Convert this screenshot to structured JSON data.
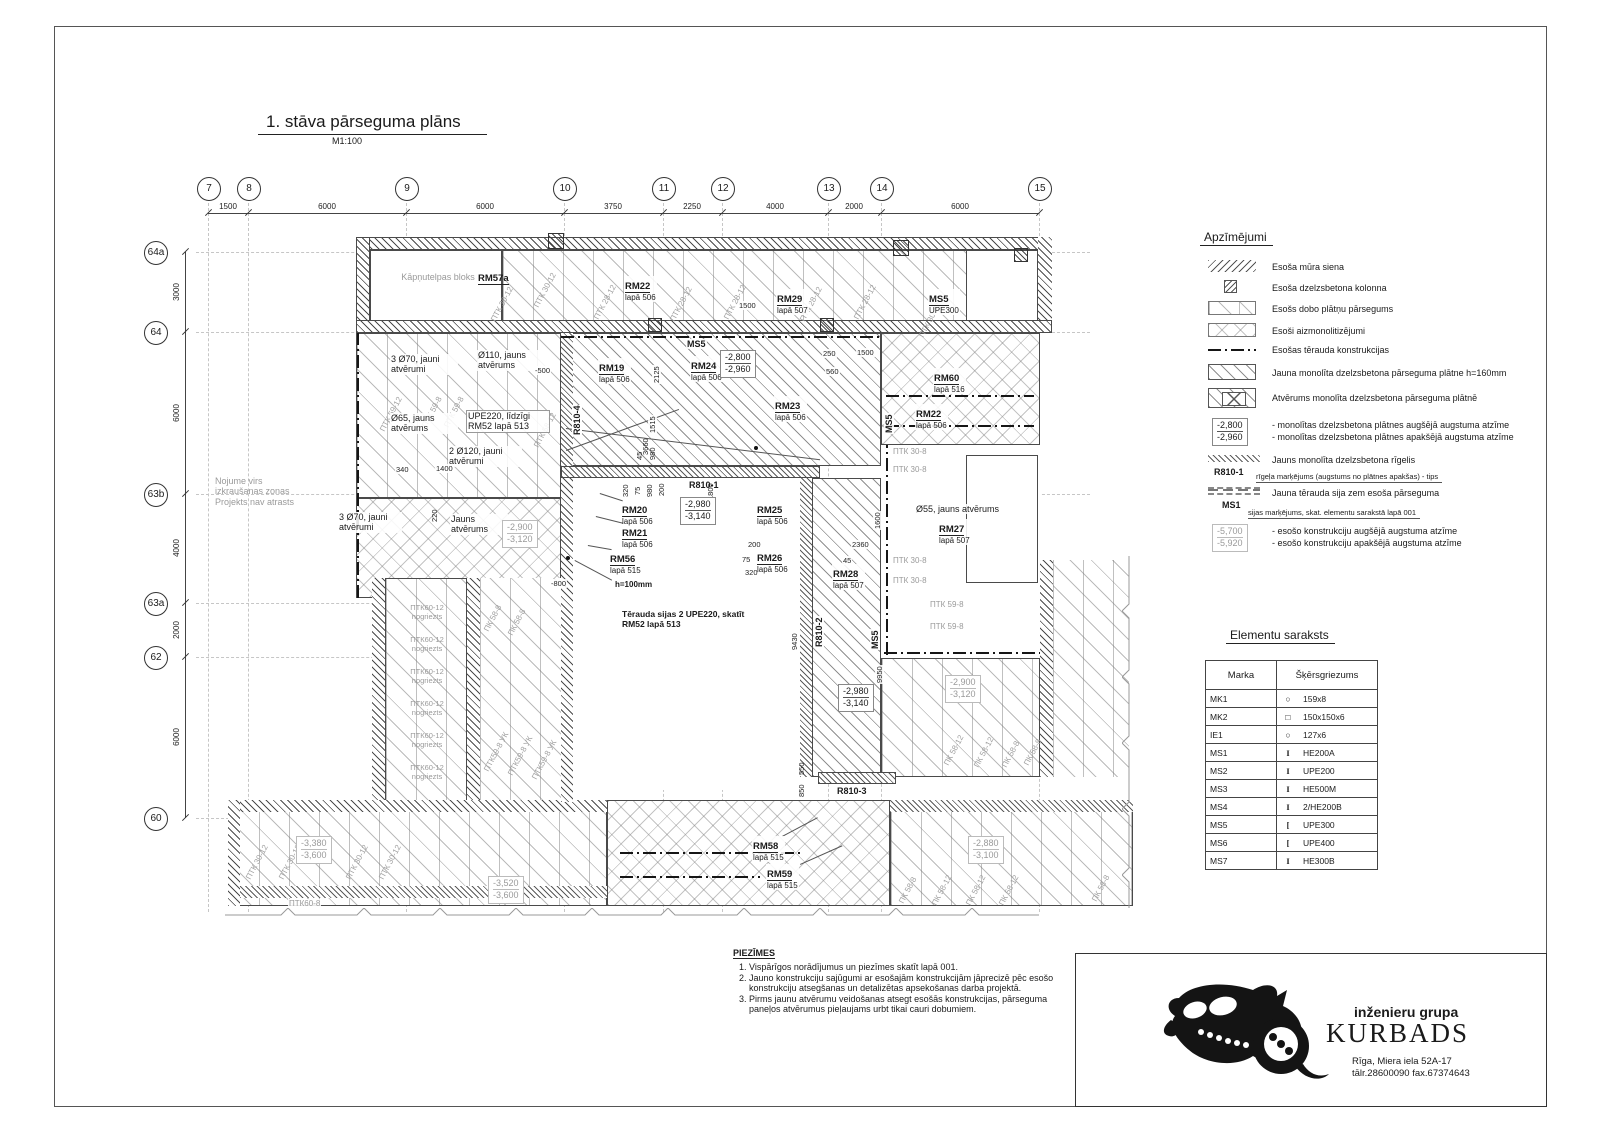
{
  "sheet": {
    "title": "1. stāva pārseguma plāns",
    "scale": "M1:100"
  },
  "colors": {
    "ink": "#1a1a1a",
    "gray_note": "#9a9a9a",
    "grid": "#c6c6c6"
  },
  "grid": {
    "col_labels": [
      "7",
      "8",
      "9",
      "10",
      "11",
      "12",
      "13",
      "14",
      "15"
    ],
    "col_dims": [
      "1500",
      "6000",
      "6000",
      "3750",
      "2250",
      "4000",
      "2000",
      "6000"
    ],
    "row_labels": [
      "64a",
      "64",
      "63b",
      "63a",
      "62",
      "60"
    ],
    "row_dims": [
      "3000",
      "6000",
      "4000",
      "2000",
      "6000"
    ]
  },
  "plan": {
    "stair_block": "Kāpņutelpas bloks",
    "canopy": {
      "l1": "Nojume virs",
      "l2": "izkraušanas zonas",
      "l3": "Projekts nav atrasts"
    },
    "marks": {
      "rm57a": {
        "name": "RM57a",
        "ref": ""
      },
      "rm22a": {
        "name": "RM22",
        "ref": "lapā 506"
      },
      "rm29": {
        "name": "RM29",
        "ref": "lapā 507"
      },
      "ms5upe": {
        "name": "MS5",
        "ref": "UPE300"
      },
      "rm19": {
        "name": "RM19",
        "ref": "lapā 506"
      },
      "ms5": {
        "name": "MS5",
        "ref": ""
      },
      "rm24": {
        "name": "RM24",
        "ref": "lapā 506"
      },
      "rm23": {
        "name": "RM23",
        "ref": "lapā 506"
      },
      "rm60": {
        "name": "RM60",
        "ref": "lapā 516"
      },
      "rm22b": {
        "name": "RM22",
        "ref": "lapā 506"
      },
      "rm20": {
        "name": "RM20",
        "ref": "lapā 506"
      },
      "rm21": {
        "name": "RM21",
        "ref": "lapā 506"
      },
      "rm56": {
        "name": "RM56",
        "ref": "lapā 515"
      },
      "rm25": {
        "name": "RM25",
        "ref": "lapā 506"
      },
      "rm26": {
        "name": "RM26",
        "ref": "lapā 506"
      },
      "rm28": {
        "name": "RM28",
        "ref": "lapā 507"
      },
      "rm27": {
        "name": "RM27",
        "ref": "lapā 507"
      },
      "rm58": {
        "name": "RM58",
        "ref": "lapā 515"
      },
      "rm59": {
        "name": "RM59",
        "ref": "lapā 515"
      },
      "r810_1": "R810-1",
      "r810_2": "R810-2",
      "r810_3": "R810-3",
      "r810_4": "R810-4"
    },
    "texts": {
      "holes70": "3 Ø70, jauni atvērumi",
      "hole110": "Ø110, jauns atvērums",
      "hole65": "Ø65, jauns atvērums",
      "holes120": "2 Ø120, jauni atvērumi",
      "hole55": "Ø55, jauns atvērums",
      "new_opening": "Jauns atvērums",
      "upe220": "UPE220, līdzīgi RM52 lapā 513",
      "steel_beams": "Tērauda sijas 2 UPE220, skatīt RM52 lapā 513",
      "h100": "h=100mm"
    },
    "panels": {
      "ptk28_12": "ПТК 28-12",
      "ptk30_12": "ПТК 30-12",
      "ptk30_8": "ПТК 30-8",
      "ptk59_12": "ПТК 59-12",
      "ptk59_8": "ПТК 59-8",
      "ptk59_8uk": "ПТК59-8 УК",
      "ptk58_12": "ПТК 58-12",
      "ptk60_12": "ПТК60-12",
      "nogriezts": "nogriezts",
      "ptk60_8": "ПТК60-8",
      "pk58_12": "ПК 58-12",
      "pk58_8": "ПК 58-8"
    },
    "elevations": {
      "e_new_a": {
        "top": "-2,800",
        "bot": "-2,960"
      },
      "e_new_b": {
        "top": "-2,980",
        "bot": "-3,140"
      },
      "e_old_2900": {
        "top": "-2,900",
        "bot": "-3,120"
      },
      "e_old_2880": {
        "top": "-2,880",
        "bot": "-3,100"
      },
      "e_old_3380": {
        "top": "-3,380",
        "bot": "-3,600"
      },
      "e_old_3520": {
        "top": "-3,520",
        "bot": "-3,600"
      }
    },
    "dims": {
      "d1500": "1500",
      "d250": "250",
      "d560": "560",
      "d2125": "2125",
      "d1515": "1515",
      "d45": "45",
      "d980": "980",
      "d320": "320",
      "d75": "75",
      "d200": "200",
      "d1800": "1800",
      "d1600": "1600",
      "d2360": "2360",
      "d9430": "9430",
      "d9950": "9950",
      "d550": "550",
      "d850": "850",
      "d340": "340",
      "d1400": "1400",
      "d220": "220",
      "d3660": "3660",
      "n500": "-500",
      "n800": "-800"
    }
  },
  "legend": {
    "title": "Apzīmējumi",
    "items": [
      {
        "label": "Esoša mūra siena"
      },
      {
        "label": "Esoša dzelzsbetona kolonna"
      },
      {
        "label": "Esošs dobo plātņu pārsegums"
      },
      {
        "label": "Esoši aizmonolitizējumi"
      },
      {
        "label": "Esošas tērauda konstrukcijas"
      },
      {
        "label": "Jauna monolīta dzelzsbetona pārseguma plātne h=160mm"
      },
      {
        "label": "Atvērums monolīta dzelzsbetona pārseguma plātnē"
      }
    ],
    "elev_new": {
      "top": "-2,800",
      "bot": "-2,960",
      "line1": "- monolītas dzelzsbetona plātnes augšējā augstuma atzīme",
      "line2": "- monolītas dzelzsbetona plātnes apakšējā augstuma atzīme"
    },
    "rigelis": {
      "label": "Jauns monolīta dzelzsbetona rīgelis",
      "mark": "R810-1",
      "sub": "rīgeļa marķējums (augstums no plātnes apakšas) - tips"
    },
    "beam": {
      "label": "Jauna tērauda sija zem esoša pārseguma",
      "mark": "MS1",
      "sub": "sijas marķējums, skat. elementu sarakstā lapā 001"
    },
    "elev_old": {
      "top": "-5,700",
      "bot": "-5,920",
      "line1": "- esošo konstrukciju augšējā augstuma atzīme",
      "line2": "- esošo konstrukciju apakšējā augstuma atzīme"
    }
  },
  "elements": {
    "title": "Elementu saraksts",
    "headers": [
      "Marka",
      "Šķērsgriezums"
    ],
    "rows": [
      {
        "marka": "MK1",
        "sym": "○",
        "section": "159x8"
      },
      {
        "marka": "MK2",
        "sym": "□",
        "section": "150x150x6"
      },
      {
        "marka": "IE1",
        "sym": "○",
        "section": "127x6"
      },
      {
        "marka": "MS1",
        "sym": "I",
        "section": "HE200A"
      },
      {
        "marka": "MS2",
        "sym": "I",
        "section": "UPE200"
      },
      {
        "marka": "MS3",
        "sym": "I",
        "section": "HE500M"
      },
      {
        "marka": "MS4",
        "sym": "I",
        "section": "2/HE200B"
      },
      {
        "marka": "MS5",
        "sym": "[",
        "section": "UPE300"
      },
      {
        "marka": "MS6",
        "sym": "[",
        "section": "UPE400"
      },
      {
        "marka": "MS7",
        "sym": "I",
        "section": "HE300B"
      }
    ]
  },
  "notes": {
    "title": "PIEZĪMES",
    "items": [
      "Vispārīgos norādījumus un piezīmes skatīt lapā 001.",
      "Jauno konstrukciju sajūgumi ar esošajām konstrukcijām jāprecizē pēc esošo konstrukciju atsegšanas un detalizētas apsekošanas darba projektā.",
      "Pirms jaunu atvērumu veidošanas atsegt esošās konstrukcijas, pārseguma paneļos atvērumus pieļaujams urbt tikai cauri dobumiem."
    ]
  },
  "titleblock": {
    "group": "inženieru grupa",
    "company": "KURBADS",
    "address": "Rīga, Miera iela 52A-17",
    "phone": "tālr.28600090 fax.67374643"
  }
}
